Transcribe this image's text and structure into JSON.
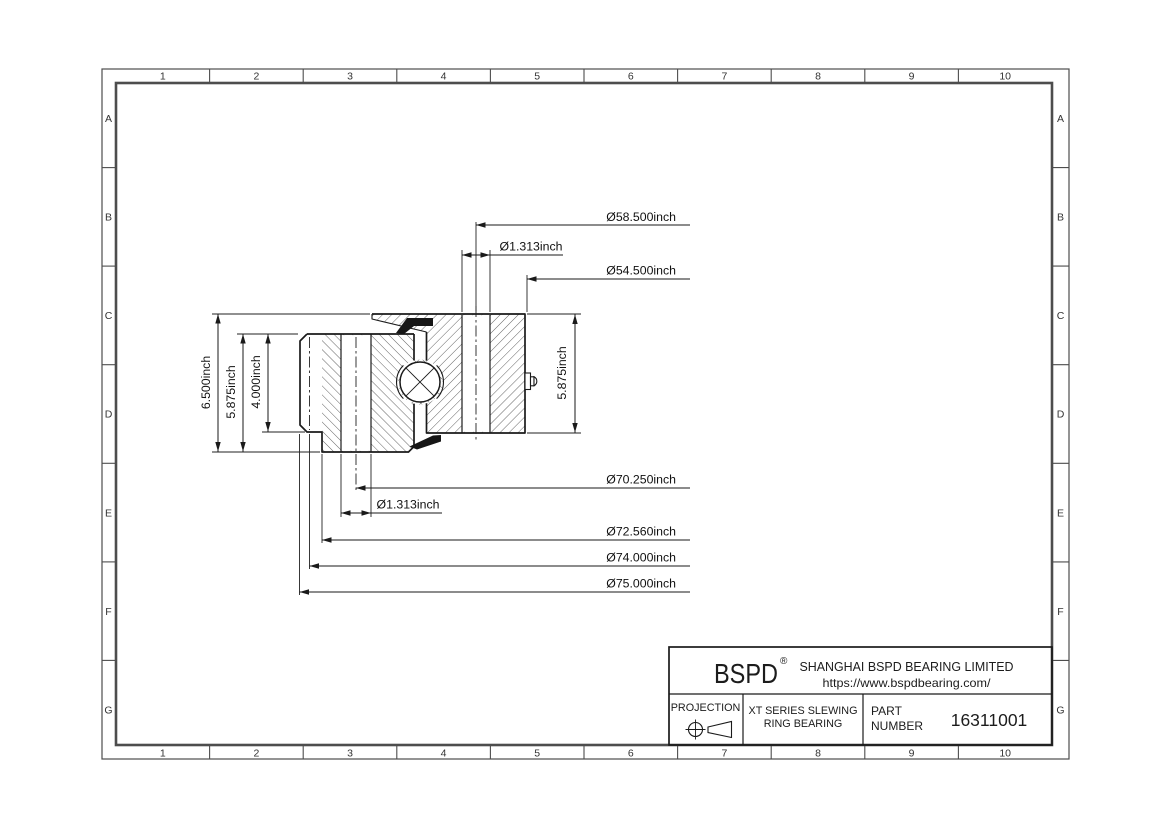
{
  "frame": {
    "columns": [
      "1",
      "2",
      "3",
      "4",
      "5",
      "6",
      "7",
      "8",
      "9",
      "10"
    ],
    "rows": [
      "A",
      "B",
      "C",
      "D",
      "E",
      "F",
      "G"
    ]
  },
  "dimensions": {
    "outer_diameter_top": "Ø58.500inch",
    "bolt_hole_top": "Ø1.313inch",
    "inner_diameter_top": "Ø54.500inch",
    "bolt_circle_bottom": "Ø70.250inch",
    "bolt_hole_bottom": "Ø1.313inch",
    "diameter_72": "Ø72.560inch",
    "diameter_74": "Ø74.000inch",
    "diameter_75": "Ø75.000inch",
    "overall_height": "6.500inch",
    "left_ring_height": "5.875inch",
    "step_height": "4.000inch",
    "right_ring_height": "5.875inch"
  },
  "title_block": {
    "brand": "BSPD",
    "registered_mark": "®",
    "company": "SHANGHAI BSPD BEARING LIMITED",
    "website": "https://www.bspdbearing.com/",
    "projection_label": "PROJECTION",
    "series_line1": "XT SERIES SLEWING",
    "series_line2": "RING BEARING",
    "part_label_line1": "PART",
    "part_label_line2": "NUMBER",
    "part_number": "16311001"
  },
  "colors": {
    "line": "#1a1a1a",
    "frame": "#4d4d4d",
    "seal": "#161616",
    "background": "#ffffff"
  }
}
